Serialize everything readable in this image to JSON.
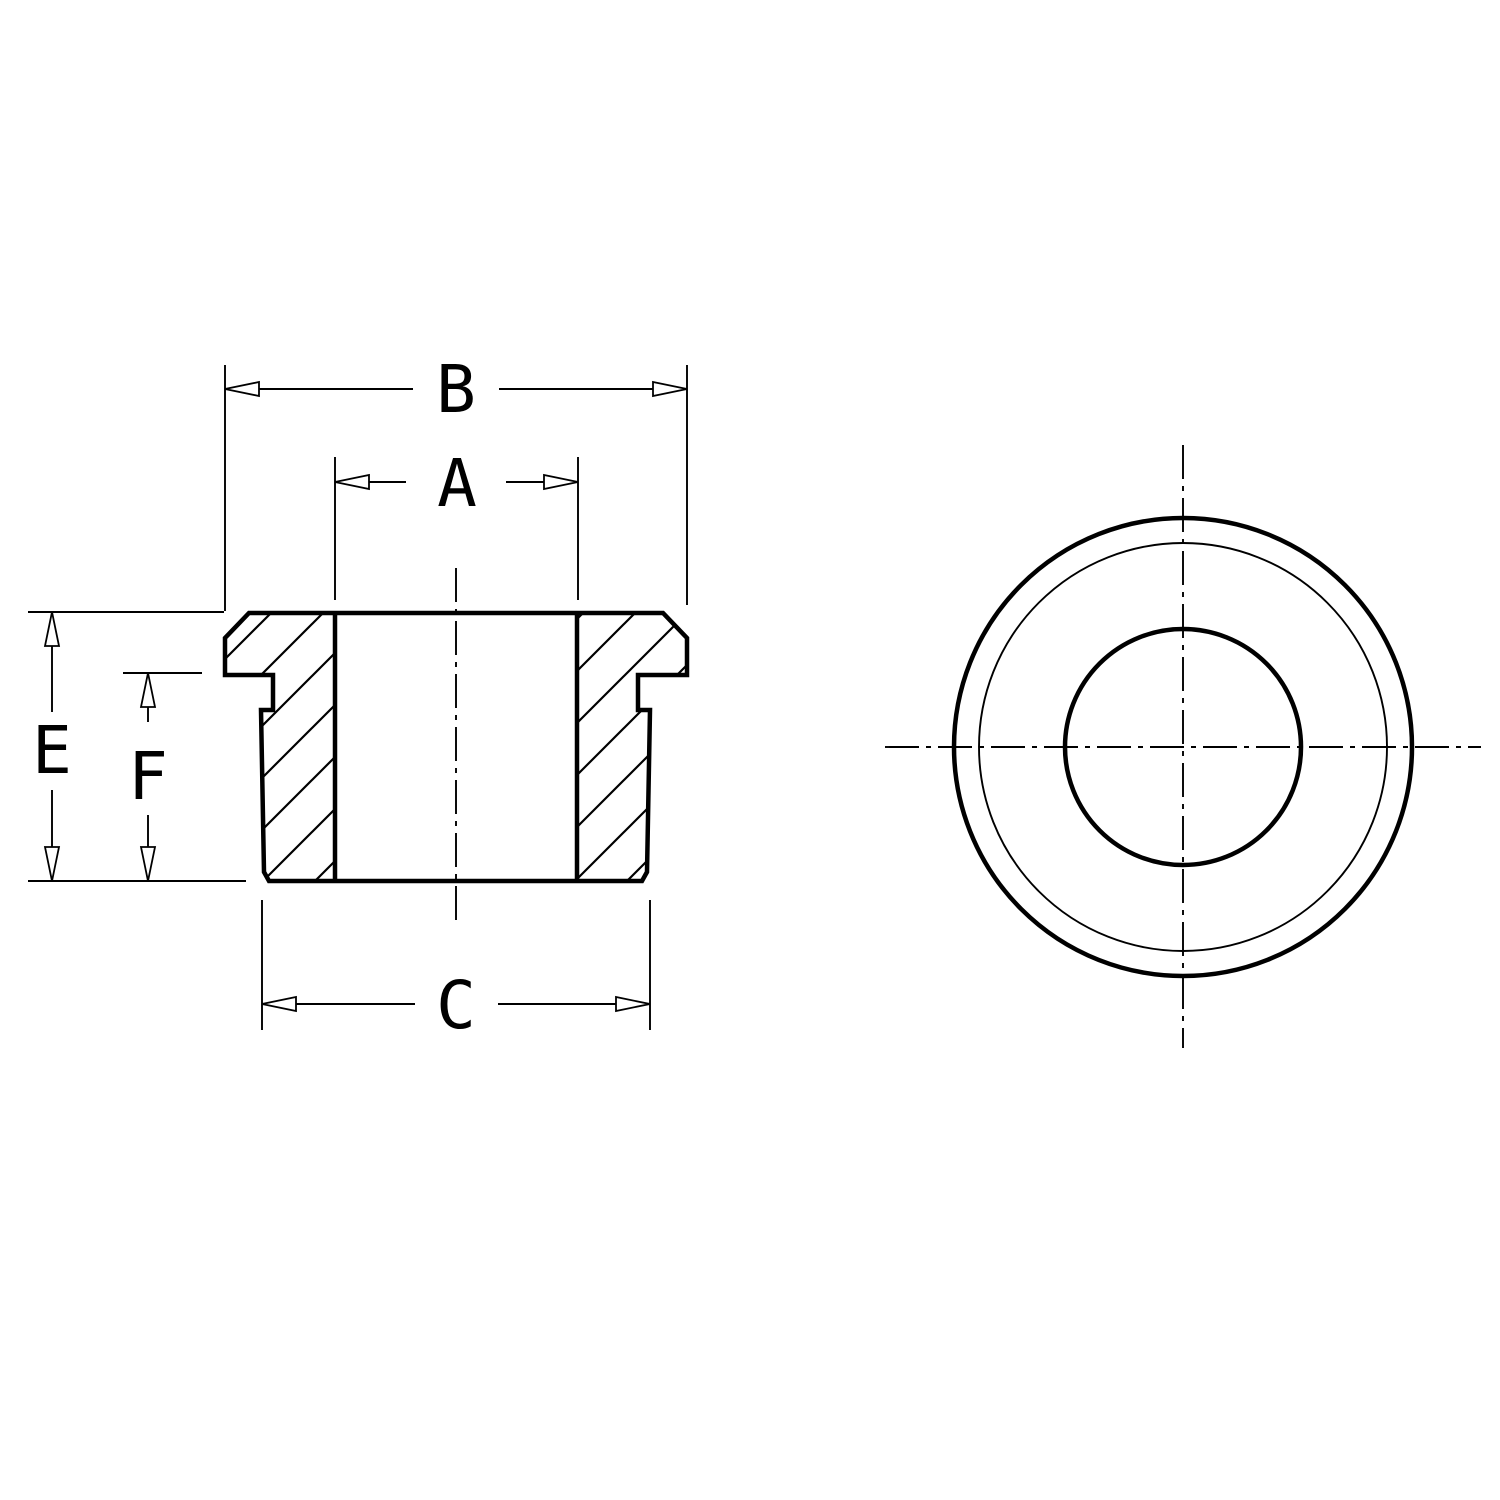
{
  "drawing": {
    "type": "engineering-drawing",
    "subject": "flanged snap bushing, section view and front view",
    "colors": {
      "background": "#ffffff",
      "line": "#000000"
    },
    "dimensions": {
      "flange_outer_diameter": {
        "label": "B"
      },
      "bore_diameter": {
        "label": "A"
      },
      "overall_height": {
        "label": "E"
      },
      "body_height": {
        "label": "F"
      },
      "body_diameter": {
        "label": "C"
      }
    }
  }
}
